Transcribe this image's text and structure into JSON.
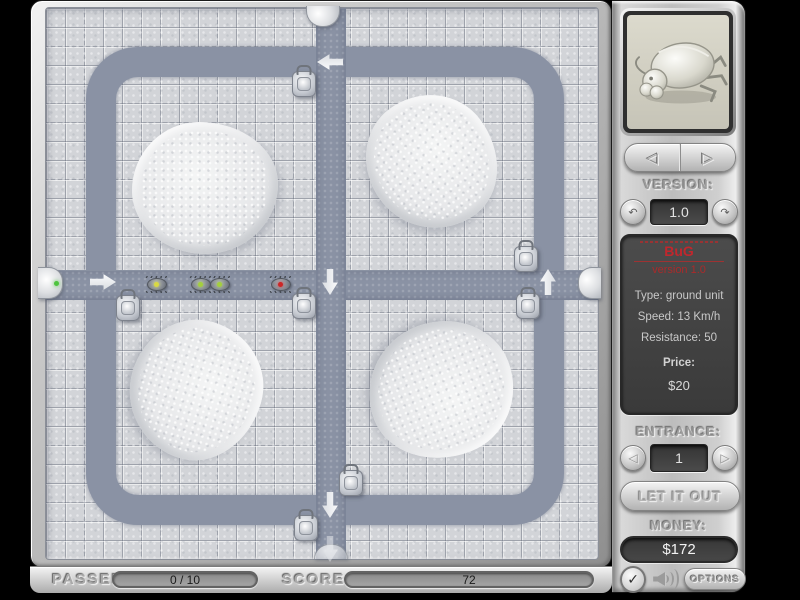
{
  "sidebar": {
    "unit_preview": "metallic bug unit",
    "version_label": "VERSION:",
    "version_value": "1.0",
    "info": {
      "title": "BuG",
      "subtitle": "version 1.0",
      "type": "Type: ground unit",
      "speed": "Speed: 13 Km/h",
      "resistance": "Resistance: 50",
      "price_label": "Price:",
      "price_value": "$20"
    },
    "entrance_label": "ENTRANCE:",
    "entrance_value": "1",
    "let_it_out_label": "LET IT OUT",
    "money_label": "MONEY:",
    "money_value": "$172",
    "options_label": "OPTIONS"
  },
  "status_bar": {
    "passed_label": "PASSED",
    "passed_value": "0 / 10",
    "score_label": "SCORE",
    "score_value": "72"
  },
  "icons": {
    "prev_unit": "◁",
    "next_unit": "▷",
    "version_down": "↶",
    "version_up": "↷",
    "entrance_prev": "◁",
    "entrance_next": "▷",
    "check": "✓"
  },
  "colors": {
    "path": "#8a92a4",
    "tile": "#d2d4d8",
    "accent_red": "#c1272d",
    "money_text": "#f2f2f2",
    "bug_dot_yellow": "#d9d943",
    "bug_dot_green": "#a4cf3c",
    "bug_dot_red": "#cc2626",
    "entrance_dot_green": "#4ec43e"
  },
  "board": {
    "mounds": [
      {
        "x": 205,
        "y": 188,
        "rx": 73,
        "ry": 66
      },
      {
        "x": 432,
        "y": 162,
        "rx": 68,
        "ry": 64
      },
      {
        "x": 196,
        "y": 390,
        "rx": 70,
        "ry": 66
      },
      {
        "x": 441,
        "y": 390,
        "rx": 73,
        "ry": 68
      }
    ],
    "turrets": [
      {
        "x": 303,
        "y": 83
      },
      {
        "x": 127,
        "y": 307
      },
      {
        "x": 303,
        "y": 305
      },
      {
        "x": 525,
        "y": 258
      },
      {
        "x": 527,
        "y": 305
      },
      {
        "x": 350,
        "y": 482
      },
      {
        "x": 305,
        "y": 527
      }
    ],
    "bugs": [
      {
        "x": 156,
        "y": 283,
        "dot": "#d9d943"
      },
      {
        "x": 200,
        "y": 283,
        "dot": "#a4cf3c"
      },
      {
        "x": 219,
        "y": 283,
        "dot": "#a4cf3c"
      },
      {
        "x": 280,
        "y": 283,
        "dot": "#cc2626"
      }
    ],
    "arrows": [
      {
        "x": 103,
        "y": 282,
        "dir": "right"
      },
      {
        "x": 330,
        "y": 62,
        "dir": "left"
      },
      {
        "x": 330,
        "y": 282,
        "dir": "down"
      },
      {
        "x": 548,
        "y": 282,
        "dir": "up"
      },
      {
        "x": 330,
        "y": 505,
        "dir": "down"
      },
      {
        "x": 330,
        "y": 549,
        "dir": "down",
        "faint": true
      }
    ],
    "gates": [
      {
        "side": "left",
        "x": 38,
        "y": 267,
        "w": 24,
        "h": 30,
        "active": true
      },
      {
        "side": "top",
        "x": 306,
        "y": 6,
        "w": 32,
        "h": 20
      },
      {
        "side": "right",
        "x": 578,
        "y": 267,
        "w": 22,
        "h": 30
      },
      {
        "side": "bottom",
        "x": 314,
        "y": 544,
        "w": 32,
        "h": 14
      }
    ]
  }
}
